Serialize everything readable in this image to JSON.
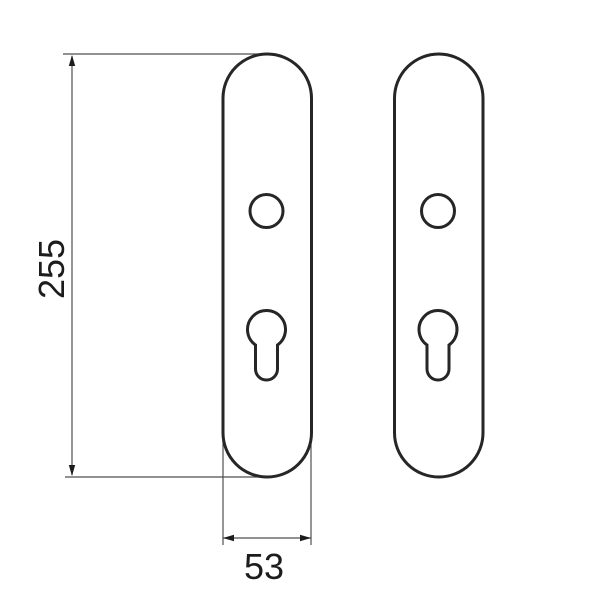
{
  "title": "Door backplate technical drawing",
  "dimensions": {
    "height_label": "255",
    "width_label": "53"
  },
  "colors": {
    "outline": "#262626",
    "dimension_line": "#4f4f4f",
    "label_text": "#1c1c1c",
    "background": "#ffffff"
  }
}
